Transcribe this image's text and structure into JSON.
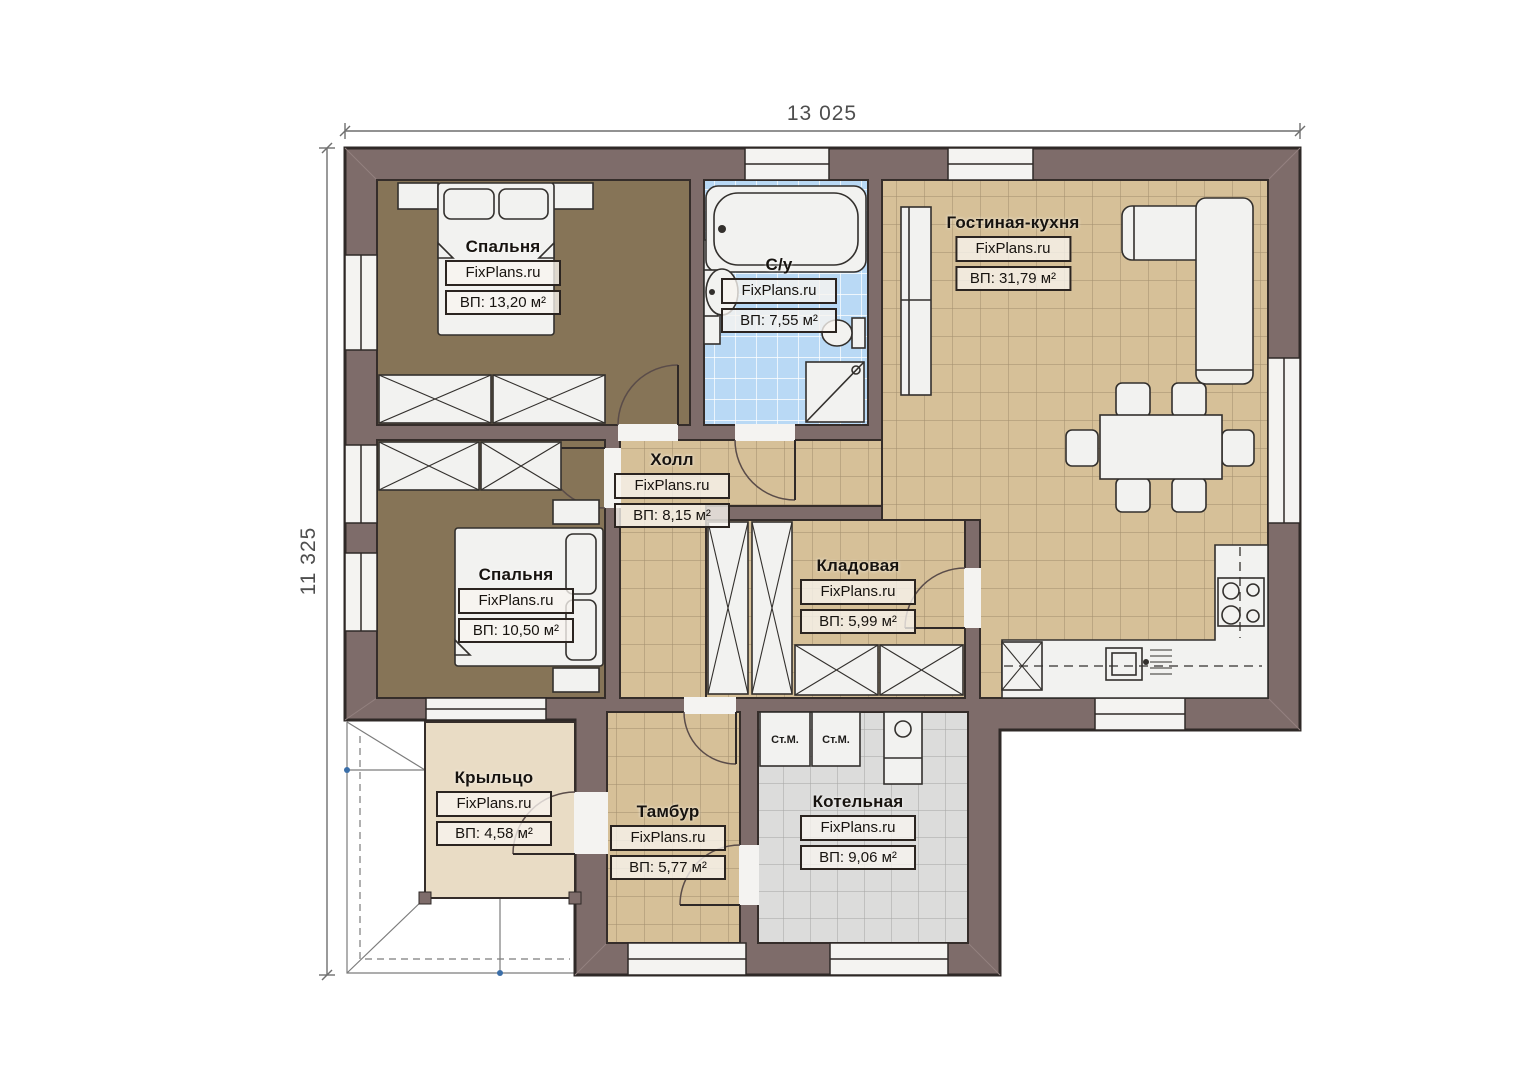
{
  "plan": {
    "type": "floor-plan",
    "watermark": "FixPlans.ru",
    "dimensions": {
      "width": "13 025",
      "height": "11 325"
    },
    "rooms": [
      {
        "id": "bedroom-1",
        "name": "Спальня",
        "watermark": "FixPlans.ru",
        "area": "ВП: 13,20 м²"
      },
      {
        "id": "bathroom",
        "name": "С/у",
        "watermark": "FixPlans.ru",
        "area": "ВП: 7,55 м²"
      },
      {
        "id": "living-kitchen",
        "name": "Гостиная-кухня",
        "watermark": "FixPlans.ru",
        "area": "ВП: 31,79 м²"
      },
      {
        "id": "hall",
        "name": "Холл",
        "watermark": "FixPlans.ru",
        "area": "ВП: 8,15 м²"
      },
      {
        "id": "bedroom-2",
        "name": "Спальня",
        "watermark": "FixPlans.ru",
        "area": "ВП: 10,50 м²"
      },
      {
        "id": "storage",
        "name": "Кладовая",
        "watermark": "FixPlans.ru",
        "area": "ВП: 5,99 м²"
      },
      {
        "id": "porch",
        "name": "Крыльцо",
        "watermark": "FixPlans.ru",
        "area": "ВП: 4,58 м²"
      },
      {
        "id": "vestibule",
        "name": "Тамбур",
        "watermark": "FixPlans.ru",
        "area": "ВП: 5,77 м²"
      },
      {
        "id": "boiler-room",
        "name": "Котельная",
        "watermark": "FixPlans.ru",
        "area": "ВП: 9,06 м²"
      }
    ],
    "appliances": {
      "washing_machine_1": "Ст.М.",
      "washing_machine_2": "Ст.М."
    },
    "colors": {
      "wall": "#7e6c6a",
      "outline": "#2f2927",
      "floor_tile_tan": "#d6c098",
      "floor_tile_blue": "#b9d9f5",
      "floor_tile_gray": "#dcdcdb",
      "floor_carpet_brown": "#867457",
      "floor_porch": "#e9dcc5",
      "furniture": "#f2f2f0"
    }
  }
}
